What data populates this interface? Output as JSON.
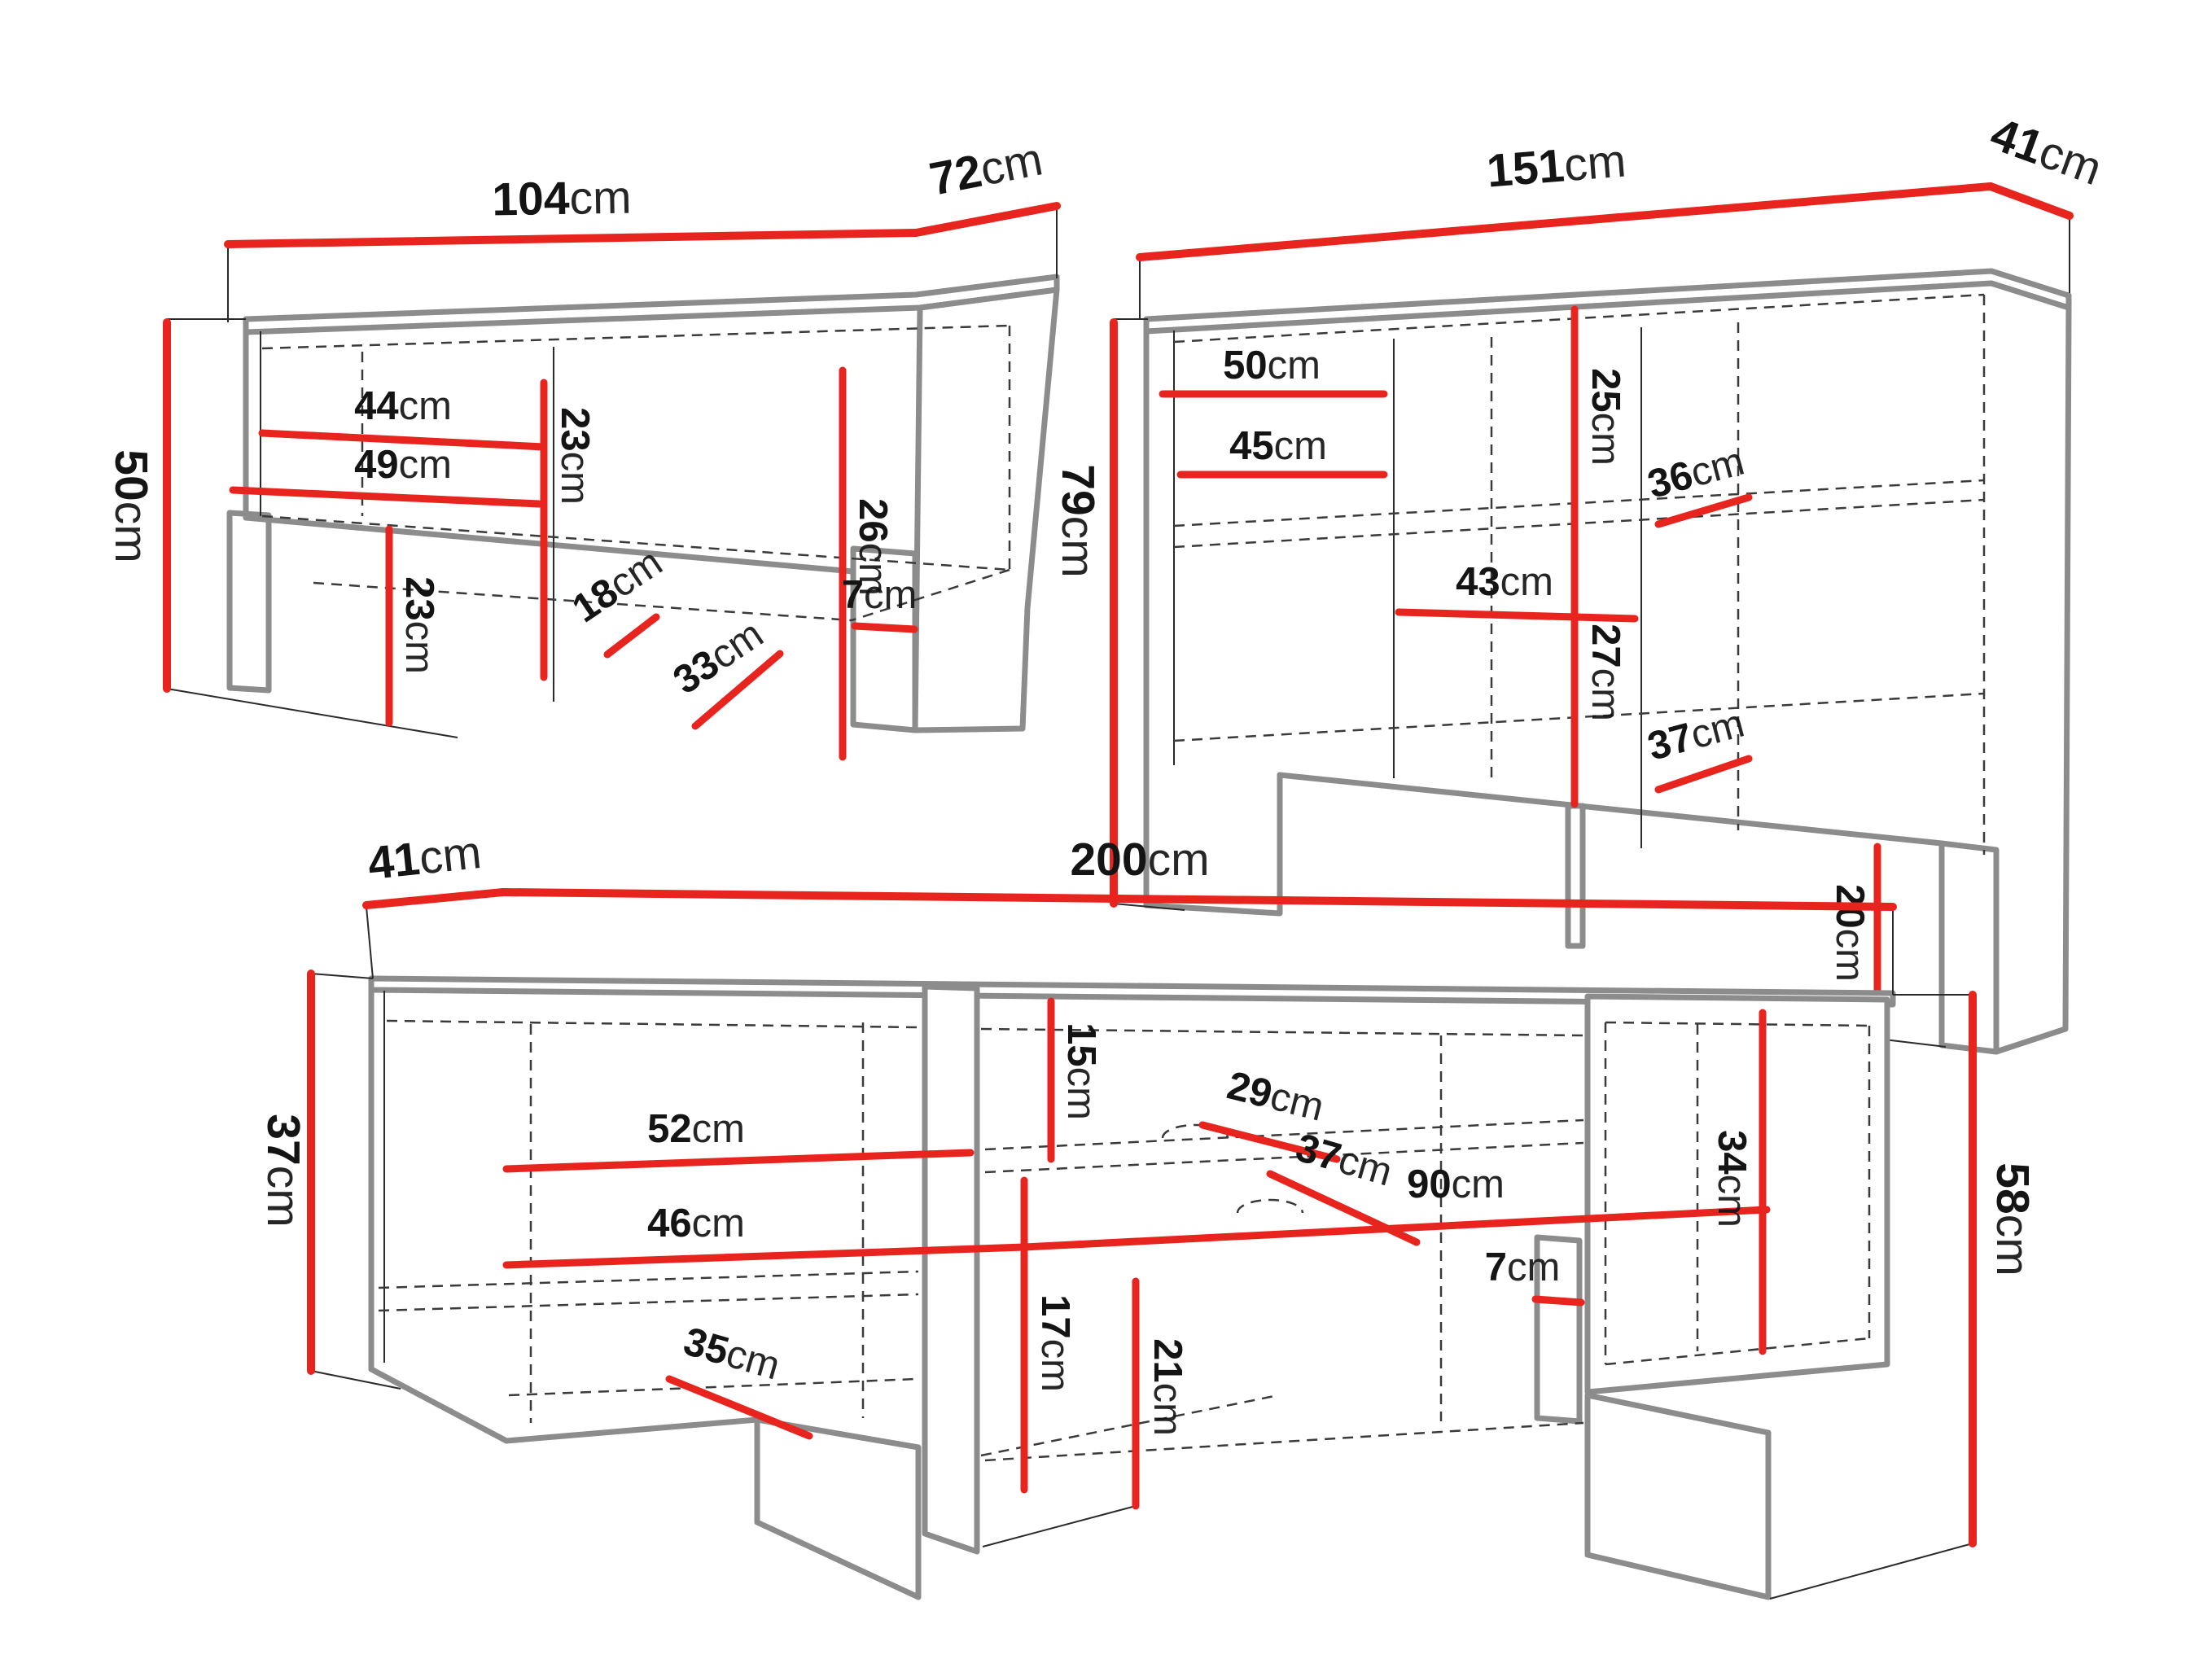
{
  "diagram_title": "furniture-dimension-diagram",
  "colors": {
    "background": "#ffffff",
    "dimension_line": "#e8241f",
    "outline": "#8c8c8c",
    "construction_line": "#3a3a3a",
    "label_text": "#141414"
  },
  "pieces": [
    {
      "name": "corner-tv-bench",
      "measurements": [
        {
          "id": "top-width",
          "value": "104",
          "unit": "cm"
        },
        {
          "id": "top-depth",
          "value": "72",
          "unit": "cm"
        },
        {
          "id": "overall-height",
          "value": "50",
          "unit": "cm"
        },
        {
          "id": "shelf-width-upper",
          "value": "44",
          "unit": "cm"
        },
        {
          "id": "shelf-width-lower",
          "value": "49",
          "unit": "cm"
        },
        {
          "id": "compartment-height",
          "value": "23",
          "unit": "cm"
        },
        {
          "id": "niche-height",
          "value": "26",
          "unit": "cm"
        },
        {
          "id": "shelf-depth-upper",
          "value": "18",
          "unit": "cm"
        },
        {
          "id": "shelf-depth-lower",
          "value": "33",
          "unit": "cm"
        },
        {
          "id": "leg-height",
          "value": "23",
          "unit": "cm"
        },
        {
          "id": "foot-height",
          "value": "7",
          "unit": "cm"
        }
      ]
    },
    {
      "name": "sideboard",
      "measurements": [
        {
          "id": "top-width",
          "value": "151",
          "unit": "cm"
        },
        {
          "id": "top-depth",
          "value": "41",
          "unit": "cm"
        },
        {
          "id": "overall-height",
          "value": "79",
          "unit": "cm"
        },
        {
          "id": "shelf-width-upper",
          "value": "50",
          "unit": "cm"
        },
        {
          "id": "shelf-width-lower",
          "value": "45",
          "unit": "cm"
        },
        {
          "id": "upper-compartment-height",
          "value": "25",
          "unit": "cm"
        },
        {
          "id": "shelf-depth-upper",
          "value": "36",
          "unit": "cm"
        },
        {
          "id": "middle-shelf-width",
          "value": "43",
          "unit": "cm"
        },
        {
          "id": "lower-compartment-height",
          "value": "27",
          "unit": "cm"
        },
        {
          "id": "shelf-depth-lower",
          "value": "37",
          "unit": "cm"
        },
        {
          "id": "leg-height",
          "value": "20",
          "unit": "cm"
        }
      ]
    },
    {
      "name": "tv-stand",
      "measurements": [
        {
          "id": "top-depth",
          "value": "41",
          "unit": "cm"
        },
        {
          "id": "top-width",
          "value": "200",
          "unit": "cm"
        },
        {
          "id": "left-height",
          "value": "37",
          "unit": "cm"
        },
        {
          "id": "upper-niche-height",
          "value": "15",
          "unit": "cm"
        },
        {
          "id": "left-shelf-width-upper",
          "value": "52",
          "unit": "cm"
        },
        {
          "id": "shelf-depth-upper",
          "value": "29",
          "unit": "cm"
        },
        {
          "id": "left-shelf-width-lower",
          "value": "46",
          "unit": "cm"
        },
        {
          "id": "right-niche-width",
          "value": "90",
          "unit": "cm"
        },
        {
          "id": "lower-niche-height",
          "value": "17",
          "unit": "cm"
        },
        {
          "id": "shelf-depth-lower-left",
          "value": "35",
          "unit": "cm"
        },
        {
          "id": "shelf-depth-lower-right",
          "value": "37",
          "unit": "cm"
        },
        {
          "id": "right-compartment-height",
          "value": "34",
          "unit": "cm"
        },
        {
          "id": "center-leg-height",
          "value": "21",
          "unit": "cm"
        },
        {
          "id": "support-width",
          "value": "7",
          "unit": "cm"
        },
        {
          "id": "right-height",
          "value": "58",
          "unit": "cm"
        }
      ]
    }
  ]
}
